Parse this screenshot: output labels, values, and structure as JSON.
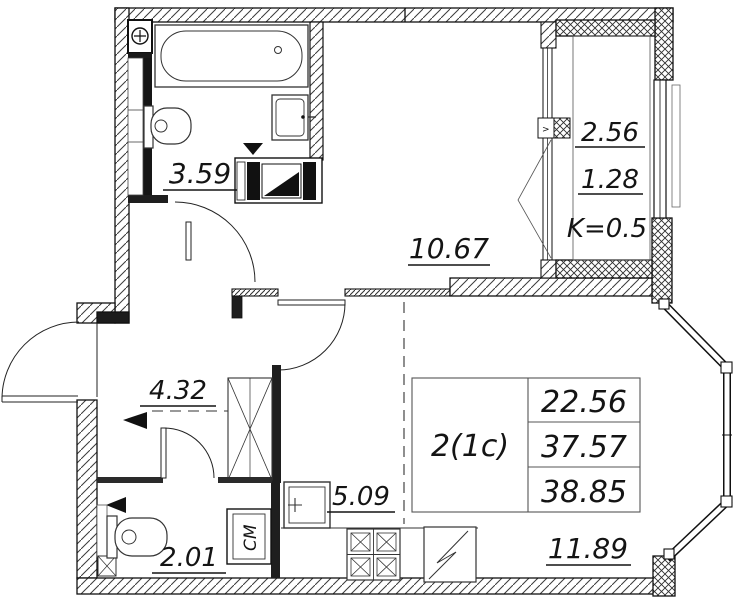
{
  "floor_plan": {
    "info_table": {
      "type": "2(1c)",
      "living_area": "22.56",
      "area": "37.57",
      "total_area": "38.85"
    },
    "room_areas": {
      "bathroom": "3.59",
      "hallway": "4.32",
      "wc": "2.01",
      "kitchen": "5.09",
      "living_room": "10.67",
      "room": "11.89"
    },
    "balcony": {
      "area": "2.56",
      "reduced_area": "1.28",
      "coefficient": "K=0.5"
    },
    "appliance_labels": {
      "washing_machine": "СМ"
    },
    "markers": {
      "vent": ">"
    },
    "colors": {
      "line": "#141414",
      "background": "#ffffff"
    }
  }
}
